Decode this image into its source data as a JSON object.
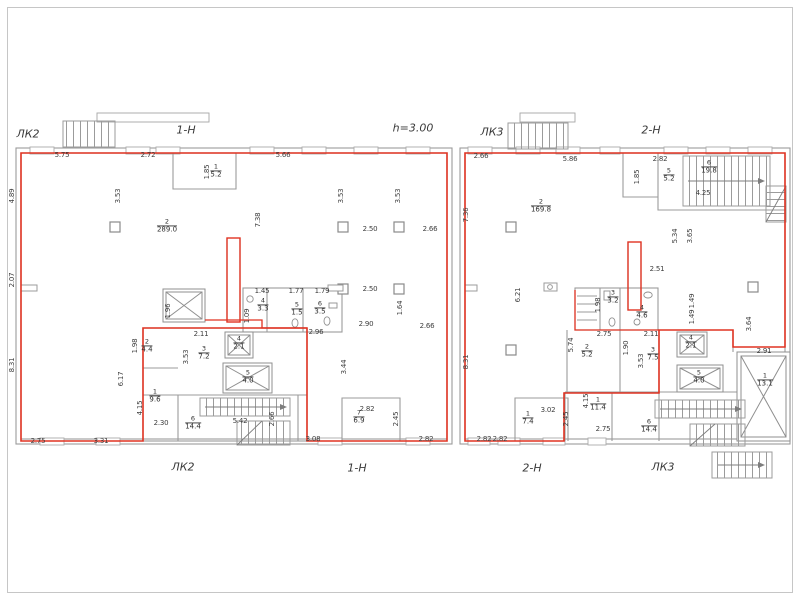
{
  "colors": {
    "premise_line": "#e03322",
    "walls": "#9b9b9b",
    "text": "#3d3d3d"
  },
  "labels": {
    "top_lk2": "ЛК2",
    "top_premise1": "1-Н",
    "height_note": "h=3.00",
    "top_lk3": "ЛК3",
    "top_premise2": "2-Н",
    "bottom_lk2": "ЛК2",
    "bottom_premise1": "1-Н",
    "bottom_premise2": "2-Н",
    "bottom_lk3": "ЛК3"
  },
  "rooms": [
    {
      "b": "left",
      "n": "1",
      "a": "5.2",
      "x": 216,
      "y": 171
    },
    {
      "b": "left",
      "n": "2",
      "a": "289.0",
      "x": 167,
      "y": 226
    },
    {
      "b": "left",
      "n": "4",
      "a": "3.3",
      "x": 263,
      "y": 305
    },
    {
      "b": "left",
      "n": "5",
      "a": "1.5",
      "x": 297,
      "y": 309
    },
    {
      "b": "left",
      "n": "6",
      "a": "3.5",
      "x": 320,
      "y": 308
    },
    {
      "b": "left",
      "n": "2",
      "a": "4.4",
      "x": 147,
      "y": 346
    },
    {
      "b": "left",
      "n": "3",
      "a": "7.2",
      "x": 204,
      "y": 353
    },
    {
      "b": "left",
      "n": "4",
      "a": "2.1",
      "x": 239,
      "y": 343
    },
    {
      "b": "left",
      "n": "5",
      "a": "4.0",
      "x": 248,
      "y": 377
    },
    {
      "b": "left",
      "n": "1",
      "a": "9.6",
      "x": 155,
      "y": 396
    },
    {
      "b": "left",
      "n": "6",
      "a": "14.4",
      "x": 193,
      "y": 423
    },
    {
      "b": "left",
      "n": "7",
      "a": "6.9",
      "x": 359,
      "y": 417
    },
    {
      "b": "right",
      "n": "2",
      "a": "169.8",
      "x": 541,
      "y": 206
    },
    {
      "b": "right",
      "n": "5",
      "a": "5.2",
      "x": 669,
      "y": 175
    },
    {
      "b": "right",
      "n": "6",
      "a": "19.8",
      "x": 709,
      "y": 167
    },
    {
      "b": "right",
      "n": "3",
      "a": "3.2",
      "x": 613,
      "y": 297
    },
    {
      "b": "right",
      "n": "4",
      "a": "4.6",
      "x": 642,
      "y": 312
    },
    {
      "b": "right",
      "n": "2",
      "a": "5.2",
      "x": 587,
      "y": 351
    },
    {
      "b": "right",
      "n": "3",
      "a": "7.5",
      "x": 653,
      "y": 354
    },
    {
      "b": "right",
      "n": "4",
      "a": "2.1",
      "x": 691,
      "y": 342
    },
    {
      "b": "right",
      "n": "5",
      "a": "4.0",
      "x": 699,
      "y": 377
    },
    {
      "b": "right",
      "n": "1",
      "a": "11.4",
      "x": 598,
      "y": 404
    },
    {
      "b": "right",
      "n": "6",
      "a": "14.4",
      "x": 649,
      "y": 426
    },
    {
      "b": "right",
      "n": "1",
      "a": "7.4",
      "x": 528,
      "y": 418
    },
    {
      "b": "right",
      "n": "1",
      "a": "13.1",
      "x": 765,
      "y": 380
    }
  ],
  "dims": [
    {
      "t": "5.75",
      "x": 62,
      "y": 155
    },
    {
      "t": "2.72",
      "x": 148,
      "y": 155
    },
    {
      "t": "5.66",
      "x": 283,
      "y": 155
    },
    {
      "t": "1.85",
      "x": 207,
      "y": 172,
      "v": 1
    },
    {
      "t": "4.89",
      "x": 12,
      "y": 196,
      "v": 1
    },
    {
      "t": "2.07",
      "x": 12,
      "y": 280,
      "v": 1
    },
    {
      "t": "8.31",
      "x": 12,
      "y": 365,
      "v": 1
    },
    {
      "t": "3.53",
      "x": 118,
      "y": 196,
      "v": 1
    },
    {
      "t": "7.38",
      "x": 258,
      "y": 220,
      "v": 1
    },
    {
      "t": "3.53",
      "x": 341,
      "y": 196,
      "v": 1
    },
    {
      "t": "3.53",
      "x": 398,
      "y": 196,
      "v": 1
    },
    {
      "t": "2.50",
      "x": 370,
      "y": 229
    },
    {
      "t": "2.66",
      "x": 430,
      "y": 229
    },
    {
      "t": "2.50",
      "x": 370,
      "y": 289
    },
    {
      "t": "2.90",
      "x": 366,
      "y": 324
    },
    {
      "t": "1.64",
      "x": 400,
      "y": 308,
      "v": 1
    },
    {
      "t": "2.66",
      "x": 427,
      "y": 326
    },
    {
      "t": "3.44",
      "x": 344,
      "y": 367,
      "v": 1
    },
    {
      "t": "1.96",
      "x": 168,
      "y": 311,
      "v": 1
    },
    {
      "t": "1.45",
      "x": 262,
      "y": 291
    },
    {
      "t": "1.77",
      "x": 296,
      "y": 291
    },
    {
      "t": "1.79",
      "x": 322,
      "y": 291
    },
    {
      "t": "1.09",
      "x": 247,
      "y": 316,
      "v": 1
    },
    {
      "t": "2.96",
      "x": 316,
      "y": 332
    },
    {
      "t": "2.11",
      "x": 201,
      "y": 334
    },
    {
      "t": "1.98",
      "x": 135,
      "y": 346,
      "v": 1
    },
    {
      "t": "3.53",
      "x": 186,
      "y": 357,
      "v": 1
    },
    {
      "t": "6.17",
      "x": 121,
      "y": 379,
      "v": 1
    },
    {
      "t": "4.15",
      "x": 140,
      "y": 408,
      "v": 1
    },
    {
      "t": "2.30",
      "x": 161,
      "y": 423
    },
    {
      "t": "5.42",
      "x": 240,
      "y": 421
    },
    {
      "t": "2.66",
      "x": 272,
      "y": 419,
      "v": 1
    },
    {
      "t": "2.75",
      "x": 38,
      "y": 441
    },
    {
      "t": "3.31",
      "x": 101,
      "y": 441
    },
    {
      "t": "3.08",
      "x": 313,
      "y": 439
    },
    {
      "t": "2.82",
      "x": 367,
      "y": 409
    },
    {
      "t": "2.45",
      "x": 396,
      "y": 419,
      "v": 1
    },
    {
      "t": "2.82",
      "x": 426,
      "y": 439
    },
    {
      "t": "2.82",
      "x": 484,
      "y": 439
    },
    {
      "t": "2.66",
      "x": 481,
      "y": 156
    },
    {
      "t": "5.86",
      "x": 570,
      "y": 159
    },
    {
      "t": "2.82",
      "x": 660,
      "y": 159
    },
    {
      "t": "1.85",
      "x": 637,
      "y": 177,
      "v": 1
    },
    {
      "t": "4.25",
      "x": 703,
      "y": 193
    },
    {
      "t": "7.36",
      "x": 466,
      "y": 215,
      "v": 1
    },
    {
      "t": "8.31",
      "x": 466,
      "y": 362,
      "v": 1
    },
    {
      "t": "6.21",
      "x": 518,
      "y": 295,
      "v": 1
    },
    {
      "t": "5.34",
      "x": 675,
      "y": 236,
      "v": 1
    },
    {
      "t": "3.65",
      "x": 690,
      "y": 236,
      "v": 1
    },
    {
      "t": "2.51",
      "x": 657,
      "y": 269
    },
    {
      "t": "1.49",
      "x": 692,
      "y": 301,
      "v": 1
    },
    {
      "t": "1.49",
      "x": 692,
      "y": 317,
      "v": 1
    },
    {
      "t": "1.98",
      "x": 598,
      "y": 305,
      "v": 1
    },
    {
      "t": "2.75",
      "x": 604,
      "y": 334
    },
    {
      "t": "2.11",
      "x": 651,
      "y": 334
    },
    {
      "t": "1.90",
      "x": 626,
      "y": 348,
      "v": 1
    },
    {
      "t": "5.74",
      "x": 571,
      "y": 345,
      "v": 1
    },
    {
      "t": "3.53",
      "x": 641,
      "y": 361,
      "v": 1
    },
    {
      "t": "3.02",
      "x": 548,
      "y": 410
    },
    {
      "t": "2.45",
      "x": 566,
      "y": 419,
      "v": 1
    },
    {
      "t": "2.82",
      "x": 500,
      "y": 439
    },
    {
      "t": "2.75",
      "x": 603,
      "y": 429
    },
    {
      "t": "4.15",
      "x": 586,
      "y": 401,
      "v": 1
    },
    {
      "t": "3.64",
      "x": 749,
      "y": 324,
      "v": 1
    },
    {
      "t": "2.91",
      "x": 764,
      "y": 351
    }
  ]
}
